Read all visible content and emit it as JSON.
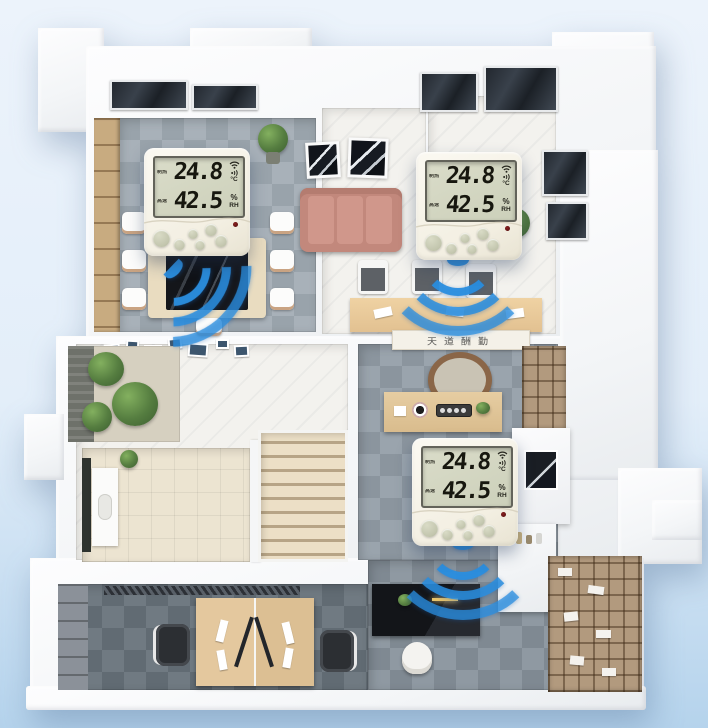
{
  "scene": {
    "background_top": "#ecf3fb",
    "background_bottom": "#b5d3ec",
    "wave_color": "#2b8fe0",
    "device_body_color": "#f6f2e7",
    "lcd_color": "#d3d6c4"
  },
  "calligraphy_banner": {
    "text": "天道酬勤"
  },
  "devices": [
    {
      "location": "meeting-room",
      "mode_label": "制热",
      "fan_label": "高速",
      "temperature": "24.8",
      "temperature_unit": "°C",
      "humidity": "42.5",
      "humidity_unit": "%",
      "humidity_suffix": "RH",
      "status_icons": [
        "wifi-icon",
        "signal-icon",
        "power-led"
      ]
    },
    {
      "location": "dining-room",
      "mode_label": "制热",
      "fan_label": "高速",
      "temperature": "24.8",
      "temperature_unit": "°C",
      "humidity": "42.5",
      "humidity_unit": "%",
      "humidity_suffix": "RH",
      "status_icons": [
        "wifi-icon",
        "signal-icon",
        "power-led"
      ]
    },
    {
      "location": "tea-room",
      "mode_label": "制热",
      "fan_label": "高速",
      "temperature": "24.8",
      "temperature_unit": "°C",
      "humidity": "42.5",
      "humidity_unit": "%",
      "humidity_suffix": "RH",
      "status_icons": [
        "wifi-icon",
        "signal-icon",
        "power-led"
      ]
    }
  ]
}
